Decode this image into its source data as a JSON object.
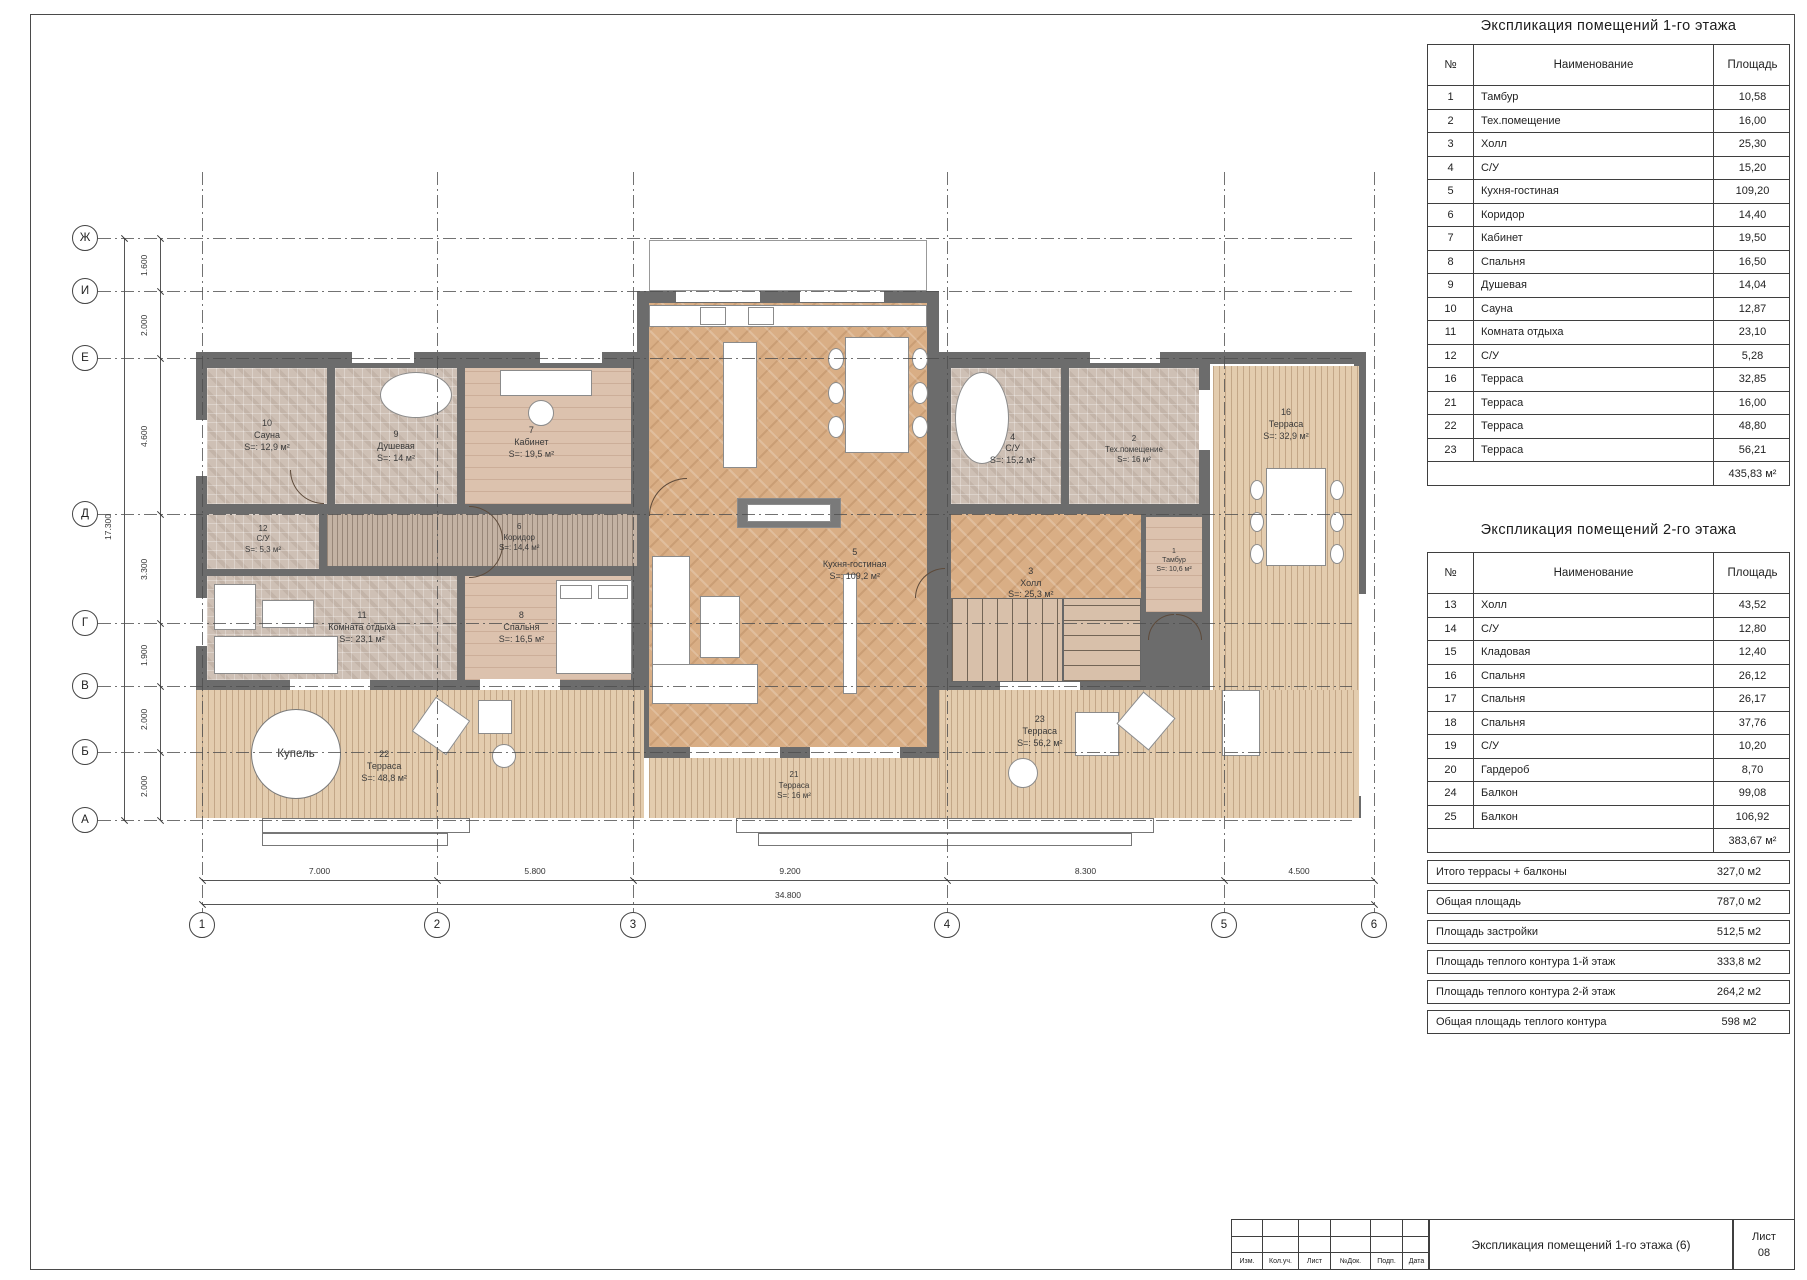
{
  "colors": {
    "wall": "#6c6c6c",
    "line": "#4e4e4e",
    "deck": "#e3ccae",
    "parquet": "#d9ae85",
    "tile": "#cec0b5"
  },
  "floor1_table": {
    "title": "Экспликация помещений 1-го этажа",
    "headers": [
      "№",
      "Наименование",
      "Площадь"
    ],
    "rows": [
      [
        "1",
        "Тамбур",
        "10,58"
      ],
      [
        "2",
        "Тех.помещение",
        "16,00"
      ],
      [
        "3",
        "Холл",
        "25,30"
      ],
      [
        "4",
        "С/У",
        "15,20"
      ],
      [
        "5",
        "Кухня-гостиная",
        "109,20"
      ],
      [
        "6",
        "Коридор",
        "14,40"
      ],
      [
        "7",
        "Кабинет",
        "19,50"
      ],
      [
        "8",
        "Спальня",
        "16,50"
      ],
      [
        "9",
        "Душевая",
        "14,04"
      ],
      [
        "10",
        "Сауна",
        "12,87"
      ],
      [
        "11",
        "Комната отдыха",
        "23,10"
      ],
      [
        "12",
        "С/У",
        "5,28"
      ],
      [
        "16",
        "Терраса",
        "32,85"
      ],
      [
        "21",
        "Терраса",
        "16,00"
      ],
      [
        "22",
        "Терраса",
        "48,80"
      ],
      [
        "23",
        "Терраса",
        "56,21"
      ]
    ],
    "total": "435,83 м²"
  },
  "floor2_table": {
    "title": "Экспликация помещений 2-го этажа",
    "headers": [
      "№",
      "Наименование",
      "Площадь"
    ],
    "rows": [
      [
        "13",
        "Холл",
        "43,52"
      ],
      [
        "14",
        "С/У",
        "12,80"
      ],
      [
        "15",
        "Кладовая",
        "12,40"
      ],
      [
        "16",
        "Спальня",
        "26,12"
      ],
      [
        "17",
        "Спальня",
        "26,17"
      ],
      [
        "18",
        "Спальня",
        "37,76"
      ],
      [
        "19",
        "С/У",
        "10,20"
      ],
      [
        "20",
        "Гардероб",
        "8,70"
      ],
      [
        "24",
        "Балкон",
        "99,08"
      ],
      [
        "25",
        "Балкон",
        "106,92"
      ]
    ],
    "total": "383,67 м²"
  },
  "summary_rows": [
    [
      "Итого террасы + балконы",
      "327,0 м2"
    ],
    [
      "Общая площадь",
      "787,0 м2"
    ],
    [
      "Площадь застройки",
      "512,5 м2"
    ],
    [
      "Площадь теплого контура 1-й этаж",
      "333,8 м2"
    ],
    [
      "Площадь теплого контура 2-й этаж",
      "264,2 м2"
    ],
    [
      "Общая площадь теплого контура",
      "598 м2"
    ]
  ],
  "title_block": {
    "stamp_cols": [
      "Изм.",
      "Кол.уч.",
      "Лист",
      "№Док.",
      "Подп.",
      "Дата"
    ],
    "doc_title": "Экспликация помещений 1-го этажа (6)",
    "sheet_label": "Лист",
    "sheet_number": "08"
  },
  "plan": {
    "axes_rows": [
      {
        "l": "Ж",
        "y": 238
      },
      {
        "l": "И",
        "y": 291
      },
      {
        "l": "Е",
        "y": 358
      },
      {
        "l": "Д",
        "y": 514
      },
      {
        "l": "Г",
        "y": 623
      },
      {
        "l": "В",
        "y": 686
      },
      {
        "l": "Б",
        "y": 752
      },
      {
        "l": "А",
        "y": 820
      }
    ],
    "axes_cols": [
      {
        "l": "1",
        "x": 202
      },
      {
        "l": "2",
        "x": 437
      },
      {
        "l": "3",
        "x": 633
      },
      {
        "l": "4",
        "x": 947
      },
      {
        "l": "5",
        "x": 1224
      },
      {
        "l": "6",
        "x": 1374
      }
    ],
    "row_dims": [
      "1.600",
      "2.000",
      "4.600",
      "3.300",
      "1.900",
      "2.000",
      "2.000"
    ],
    "row_total": "17.300",
    "col_dims": [
      "7.000",
      "5.800",
      "9.200",
      "8.300",
      "4.500"
    ],
    "col_total": "34.800",
    "walls": [
      [
        196,
        352,
        448,
        338
      ],
      [
        637,
        291,
        302,
        467
      ],
      [
        939,
        352,
        271,
        338
      ],
      [
        1206,
        352,
        160,
        12
      ],
      [
        1354,
        352,
        12,
        240
      ],
      [
        1340,
        570,
        26,
        24
      ],
      [
        1335,
        796,
        26,
        22
      ]
    ],
    "porch": [
      649,
      240,
      278,
      51
    ],
    "rooms": [
      {
        "num": "10",
        "name": "Сауна",
        "area": "S=: 12,9 м²",
        "rect": [
          207,
          368,
          120,
          136
        ],
        "floor": "tile"
      },
      {
        "num": "9",
        "name": "Душевая",
        "area": "S=: 14 м²",
        "rect": [
          335,
          368,
          122,
          136
        ],
        "floor": "tile",
        "ly": 0.58
      },
      {
        "num": "7",
        "name": "Кабинет",
        "area": "S=: 19,5 м²",
        "rect": [
          465,
          368,
          166,
          136
        ],
        "floor": "wood",
        "lx": 0.4,
        "ly": 0.55
      },
      {
        "num": "12",
        "name": "С/У",
        "area": "S=: 5,3 м²",
        "rect": [
          207,
          514,
          112,
          55
        ],
        "floor": "tile",
        "fs": 8
      },
      {
        "num": "6",
        "name": "Коридор",
        "area": "S=: 14,4 м²",
        "rect": [
          327,
          514,
          310,
          52
        ],
        "floor": "deckdark",
        "fs": 8,
        "lx": 0.62
      },
      {
        "num": "11",
        "name": "Комната отдыха",
        "area": "S=: 23,1 м²",
        "rect": [
          207,
          576,
          250,
          104
        ],
        "floor": "tile",
        "lx": 0.62
      },
      {
        "num": "8",
        "name": "Спальня",
        "area": "S=: 16,5 м²",
        "rect": [
          465,
          576,
          166,
          104
        ],
        "floor": "wood",
        "lx": 0.34
      },
      {
        "num": "5",
        "name": "Кухня-гостиная",
        "area": "S=: 109,2 м²",
        "rect": [
          649,
          303,
          278,
          444
        ],
        "floor": "herring",
        "lx": 0.74,
        "ly": 0.59
      },
      {
        "num": "4",
        "name": "С/У",
        "area": "S=: 15,2 м²",
        "rect": [
          951,
          368,
          110,
          136
        ],
        "floor": "tile",
        "lx": 0.56,
        "ly": 0.6
      },
      {
        "num": "2",
        "name": "Тех.помещение",
        "area": "S=: 16 м²",
        "rect": [
          1069,
          368,
          130,
          136
        ],
        "floor": "tile",
        "ly": 0.62,
        "fs": 8
      },
      {
        "num": "3",
        "name": "Холл",
        "area": "S=: 25,3 м²",
        "rect": [
          951,
          514,
          190,
          166
        ],
        "floor": "herring",
        "lx": 0.42,
        "ly": 0.42
      },
      {
        "num": "1",
        "name": "Тамбур",
        "area": "S=: 10,6 м²",
        "rect": [
          1146,
          517,
          56,
          95
        ],
        "floor": "wood",
        "fs": 7
      },
      {
        "num": "16",
        "name": "Терраса",
        "area": "S=: 32,9 м²",
        "rect": [
          1213,
          366,
          146,
          218
        ],
        "floor": "deck",
        "ly": 0.27
      },
      {
        "num": "22",
        "name": "Терраса",
        "area": "S=: 48,8 м²",
        "rect": [
          196,
          690,
          448,
          128
        ],
        "floor": "deck",
        "lx": 0.42,
        "ly": 0.6
      },
      {
        "num": "21",
        "name": "Терраса",
        "area": "S=: 16 м²",
        "rect": [
          649,
          758,
          290,
          60
        ],
        "floor": "deck",
        "fs": 8
      },
      {
        "num": "23",
        "name": "Терраса",
        "area": "S=: 56,2 м²",
        "rect": [
          939,
          690,
          420,
          128
        ],
        "floor": "deck",
        "lx": 0.24,
        "ly": 0.33
      }
    ],
    "deck_patches": [
      [
        1213,
        584,
        146,
        106
      ]
    ],
    "windows": [
      [
        352,
        352,
        62,
        11
      ],
      [
        540,
        352,
        62,
        11
      ],
      [
        196,
        420,
        11,
        56
      ],
      [
        196,
        598,
        11,
        48
      ],
      [
        676,
        291,
        84,
        11
      ],
      [
        800,
        291,
        84,
        11
      ],
      [
        1090,
        352,
        70,
        11
      ],
      [
        1199,
        390,
        11,
        60
      ],
      [
        690,
        747,
        90,
        11
      ],
      [
        810,
        747,
        90,
        11
      ],
      [
        290,
        679,
        80,
        11
      ],
      [
        480,
        679,
        80,
        11
      ],
      [
        1000,
        679,
        80,
        11
      ]
    ],
    "furniture": [
      {
        "r": [
          380,
          372,
          72,
          46
        ],
        "sh": "e"
      },
      {
        "r": [
          955,
          372,
          54,
          92
        ],
        "sh": "e"
      },
      {
        "r": [
          500,
          370,
          92,
          26
        ]
      },
      {
        "r": [
          528,
          400,
          26,
          26
        ],
        "sh": "e"
      },
      {
        "r": [
          556,
          580,
          76,
          94
        ]
      },
      {
        "r": [
          560,
          585,
          32,
          14
        ]
      },
      {
        "r": [
          598,
          585,
          30,
          14
        ]
      },
      {
        "r": [
          214,
          636,
          124,
          38
        ]
      },
      {
        "r": [
          214,
          584,
          42,
          46
        ]
      },
      {
        "r": [
          262,
          600,
          52,
          28
        ]
      },
      {
        "r": [
          649,
          305,
          278,
          22
        ]
      },
      {
        "r": [
          700,
          307,
          26,
          18
        ]
      },
      {
        "r": [
          748,
          307,
          26,
          18
        ]
      },
      {
        "r": [
          723,
          342,
          34,
          126
        ]
      },
      {
        "r": [
          845,
          337,
          64,
          116
        ]
      },
      {
        "r": [
          828,
          348,
          16,
          22
        ],
        "sh": "e"
      },
      {
        "r": [
          828,
          382,
          16,
          22
        ],
        "sh": "e"
      },
      {
        "r": [
          828,
          416,
          16,
          22
        ],
        "sh": "e"
      },
      {
        "r": [
          912,
          348,
          16,
          22
        ],
        "sh": "e"
      },
      {
        "r": [
          912,
          382,
          16,
          22
        ],
        "sh": "e"
      },
      {
        "r": [
          912,
          416,
          16,
          22
        ],
        "sh": "e"
      },
      {
        "r": [
          737,
          498,
          104,
          30
        ],
        "f": "#7a7a7a"
      },
      {
        "r": [
          747,
          504,
          84,
          18
        ]
      },
      {
        "r": [
          652,
          556,
          38,
          148
        ]
      },
      {
        "r": [
          652,
          664,
          106,
          40
        ]
      },
      {
        "r": [
          700,
          596,
          40,
          62
        ]
      },
      {
        "r": [
          843,
          574,
          14,
          120
        ]
      },
      {
        "r": [
          1266,
          468,
          60,
          98
        ]
      },
      {
        "r": [
          1250,
          480,
          14,
          20
        ],
        "sh": "e"
      },
      {
        "r": [
          1250,
          512,
          14,
          20
        ],
        "sh": "e"
      },
      {
        "r": [
          1250,
          544,
          14,
          20
        ],
        "sh": "e"
      },
      {
        "r": [
          1330,
          480,
          14,
          20
        ],
        "sh": "e"
      },
      {
        "r": [
          1330,
          512,
          14,
          20
        ],
        "sh": "e"
      },
      {
        "r": [
          1330,
          544,
          14,
          20
        ],
        "sh": "e"
      },
      {
        "r": [
          420,
          705,
          42,
          42
        ],
        "rot": 35
      },
      {
        "r": [
          478,
          700,
          34,
          34
        ]
      },
      {
        "r": [
          1075,
          712,
          44,
          44
        ]
      },
      {
        "r": [
          1125,
          700,
          42,
          42
        ],
        "rot": 40
      },
      {
        "r": [
          1008,
          758,
          30,
          30
        ],
        "sh": "e"
      },
      {
        "r": [
          492,
          744,
          24,
          24
        ],
        "sh": "e"
      },
      {
        "r": [
          1222,
          690,
          38,
          66
        ]
      }
    ],
    "stairs": [
      {
        "r": [
          951,
          598,
          112,
          84
        ],
        "dir": "v"
      },
      {
        "r": [
          1063,
          598,
          78,
          84
        ],
        "dir": "h"
      }
    ],
    "steps": [
      [
        262,
        818,
        208,
        15
      ],
      [
        262,
        833,
        186,
        13
      ],
      [
        736,
        818,
        418,
        15
      ],
      [
        758,
        833,
        374,
        13
      ]
    ],
    "doors": [
      {
        "x": 469,
        "y": 506,
        "s": 34,
        "c": "tr"
      },
      {
        "x": 469,
        "y": 544,
        "s": 34,
        "c": "br"
      },
      {
        "x": 290,
        "y": 470,
        "s": 34,
        "c": "bl"
      },
      {
        "x": 649,
        "y": 478,
        "s": 38,
        "c": "tl"
      },
      {
        "x": 915,
        "y": 568,
        "s": 30,
        "c": "tl"
      },
      {
        "x": 1148,
        "y": 614,
        "s": 26,
        "c": "tl"
      },
      {
        "x": 1176,
        "y": 614,
        "s": 26,
        "c": "tr"
      }
    ],
    "kupel": {
      "cx": 296,
      "cy": 754,
      "r": 45,
      "label": "Купель"
    }
  }
}
